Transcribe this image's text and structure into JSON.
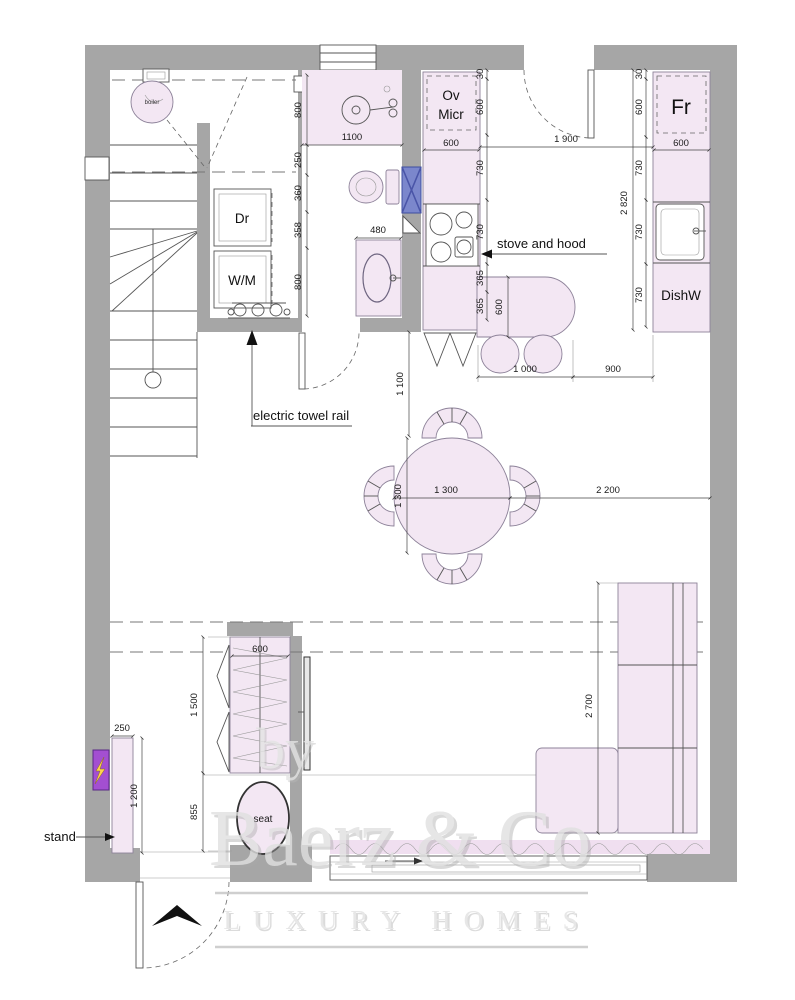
{
  "labels": {
    "boiler": "boiler",
    "dryer": "Dr",
    "washer": "W/M",
    "oven": "Ov",
    "micro": "Micr",
    "fridge": "Fr",
    "dishwasher": "DishW",
    "seat": "seat"
  },
  "annotations": {
    "stove_hood": "stove and hood",
    "towel_rail": "electric towel rail",
    "stand": "stand"
  },
  "dims": {
    "shower_depth": "800",
    "bath_width": "1100",
    "wc_wall": "250",
    "wc_width": "360",
    "wc_gap": "358",
    "basin_zone": "800",
    "basin_width": "480",
    "kl_offset": "30",
    "kl_tall_unit": "600",
    "kl_counter_a": "730",
    "kl_counter_b": "730",
    "kl_bar_a": "365",
    "kl_bar_b": "365",
    "kl_unit_width": "600",
    "bar_width": "600",
    "bar_length": "1 000",
    "kitchen_walkway": "900",
    "kitchen_opening": "1 900",
    "kr_offset": "30",
    "kr_fridge": "600",
    "kr_counter_a": "730",
    "kr_counter_b": "730",
    "kr_counter_c": "730",
    "kr_total": "2 820",
    "kr_unit_width": "600",
    "hall_passage": "1 100",
    "table_width": "1 300",
    "table_depth": "1 300",
    "table_to_wall": "2 200",
    "sofa_length": "2 700",
    "wardrobe_width": "600",
    "wardrobe_height": "1 500",
    "wardrobe_below": "855",
    "stand_depth": "250",
    "stand_length": "1 200"
  },
  "watermark": {
    "by": "by",
    "brand": "Baerz & Co",
    "tagline": "LUXURY HOMES"
  },
  "colors": {
    "wall": "#a6a6a6",
    "furniture": "#f3e7f3",
    "duct_blue": "#7b87cc",
    "panel_purple": "#a34fd1",
    "bolt_yellow": "#ffd34d"
  }
}
